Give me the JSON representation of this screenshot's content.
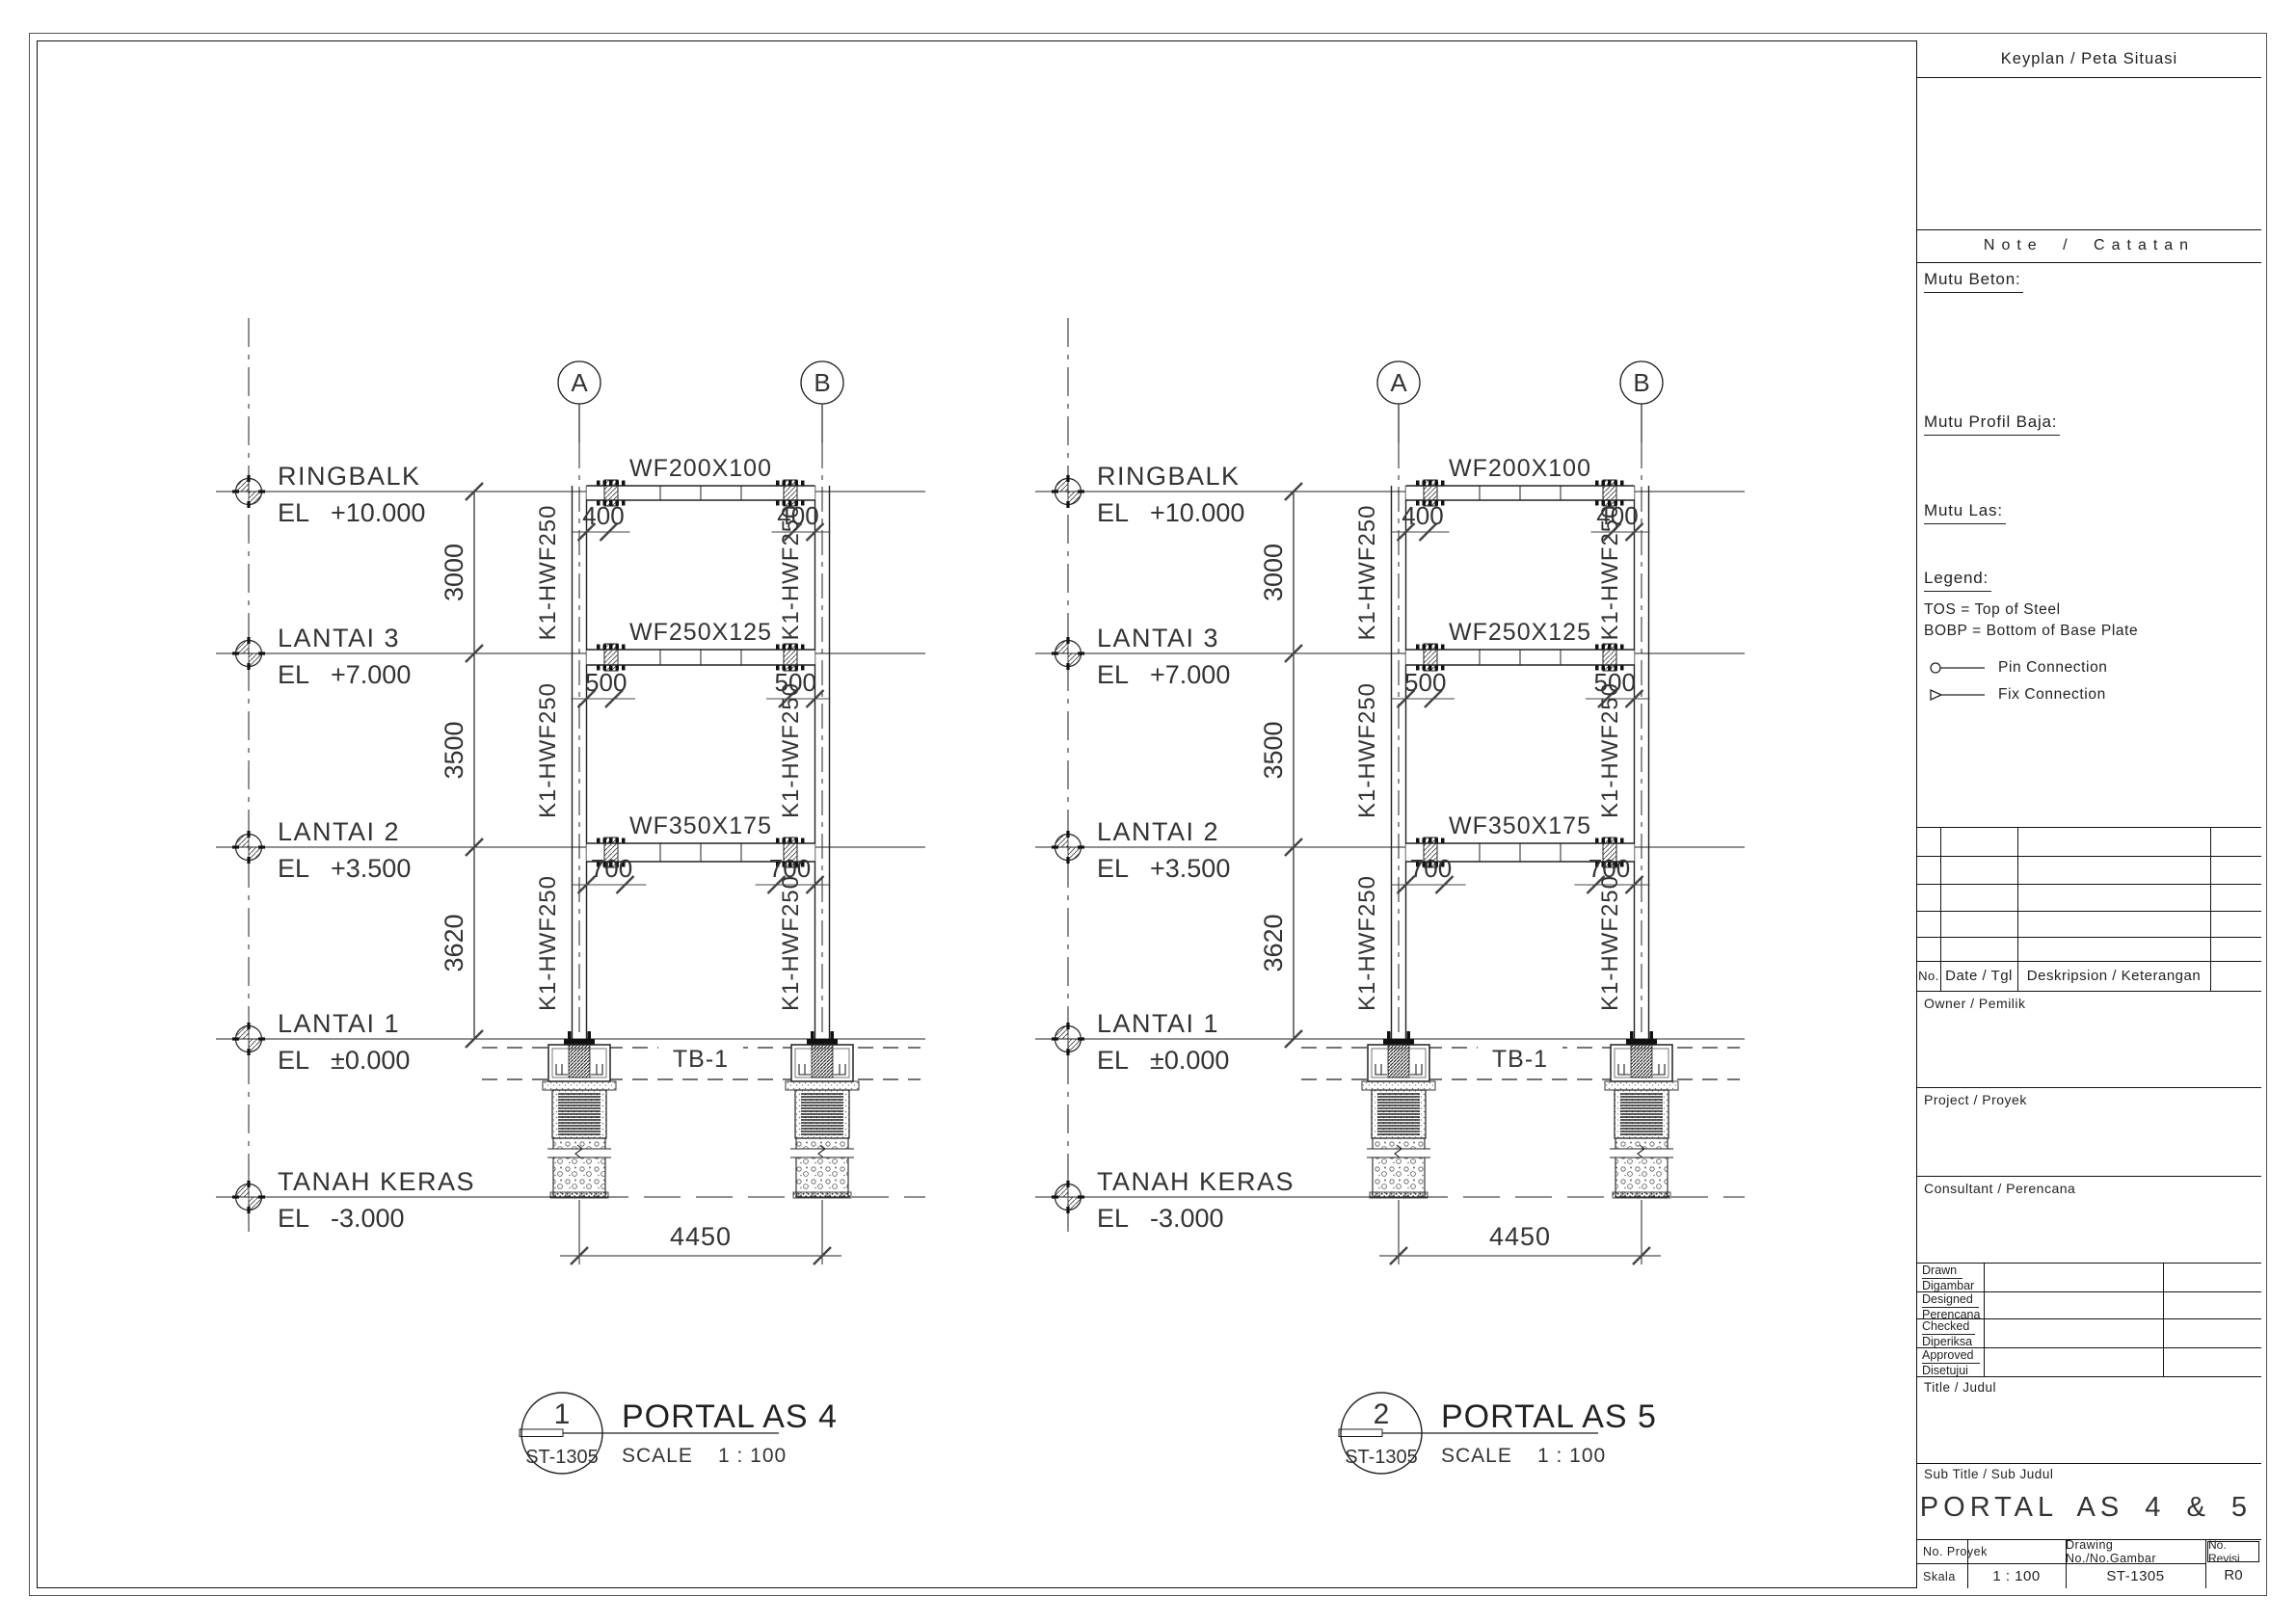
{
  "sheet": {
    "background": "#ffffff",
    "line_color": "#222222"
  },
  "portals": [
    {
      "grid_labels": [
        "A",
        "B"
      ],
      "levels": [
        {
          "name": "RINGBALK",
          "prefix": "EL",
          "value": "+10.000"
        },
        {
          "name": "LANTAI 3",
          "prefix": "EL",
          "value": "+7.000"
        },
        {
          "name": "LANTAI 2",
          "prefix": "EL",
          "value": "+3.500"
        },
        {
          "name": "LANTAI 1",
          "prefix": "EL",
          "value": "±0.000"
        },
        {
          "name": "TANAH KERAS",
          "prefix": "EL",
          "value": "-3.000"
        }
      ],
      "story_dims": [
        "3000",
        "3500",
        "3620"
      ],
      "beams": [
        {
          "label": "WF200X100",
          "end_dim": "400"
        },
        {
          "label": "WF250X125",
          "end_dim": "500"
        },
        {
          "label": "WF350X175",
          "end_dim": "700"
        }
      ],
      "column_label": "K1-HWF250",
      "tie_beam_label": "TB-1",
      "span_dim": "4450",
      "bubble": {
        "number": "1",
        "ref": "ST-1305",
        "title": "PORTAL AS 4",
        "scale_label": "SCALE",
        "scale_value": "1 : 100"
      }
    },
    {
      "grid_labels": [
        "A",
        "B"
      ],
      "levels": [
        {
          "name": "RINGBALK",
          "prefix": "EL",
          "value": "+10.000"
        },
        {
          "name": "LANTAI 3",
          "prefix": "EL",
          "value": "+7.000"
        },
        {
          "name": "LANTAI 2",
          "prefix": "EL",
          "value": "+3.500"
        },
        {
          "name": "LANTAI 1",
          "prefix": "EL",
          "value": "±0.000"
        },
        {
          "name": "TANAH KERAS",
          "prefix": "EL",
          "value": "-3.000"
        }
      ],
      "story_dims": [
        "3000",
        "3500",
        "3620"
      ],
      "beams": [
        {
          "label": "WF200X100",
          "end_dim": "400"
        },
        {
          "label": "WF250X125",
          "end_dim": "500"
        },
        {
          "label": "WF350X175",
          "end_dim": "700"
        }
      ],
      "column_label": "K1-HWF250",
      "tie_beam_label": "TB-1",
      "span_dim": "4450",
      "bubble": {
        "number": "2",
        "ref": "ST-1305",
        "title": "PORTAL AS 5",
        "scale_label": "SCALE",
        "scale_value": "1 : 100"
      }
    }
  ],
  "titleblock": {
    "keyplan_header": "Keyplan / Peta Situasi",
    "note_header": "Note / Catatan",
    "mutu_beton": "Mutu Beton:",
    "mutu_profil_baja": "Mutu Profil Baja:",
    "mutu_las": "Mutu Las:",
    "legend_header": "Legend:",
    "legend_tos": "TOS = Top of Steel",
    "legend_bobp": "BOBP = Bottom of Base Plate",
    "legend_pin": "Pin Connection",
    "legend_fix": "Fix Connection",
    "revision": {
      "no": "No.",
      "date": "Date / Tgl",
      "desc": "Deskripsion / Keterangan"
    },
    "owner_label": "Owner / Pemilik",
    "project_label": "Project / Proyek",
    "consultant_label": "Consultant / Perencana",
    "signoff": [
      {
        "en": "Drawn",
        "id": "Digambar"
      },
      {
        "en": "Designed",
        "id": "Perencana"
      },
      {
        "en": "Checked",
        "id": "Diperiksa"
      },
      {
        "en": "Approved",
        "id": "Disetujui"
      }
    ],
    "title_label": "Title / Judul",
    "subtitle_label": "Sub Title / Sub Judul",
    "subtitle_value": "PORTAL AS 4 & 5",
    "footer": {
      "no_proyek_label": "No. Proyek",
      "skala_label": "Skala",
      "skala_value": "1 : 100",
      "drawing_label": "Drawing No./No.Gambar",
      "drawing_value": "ST-1305",
      "revisi_label": "No. Revisi",
      "revisi_value": "R0"
    }
  }
}
